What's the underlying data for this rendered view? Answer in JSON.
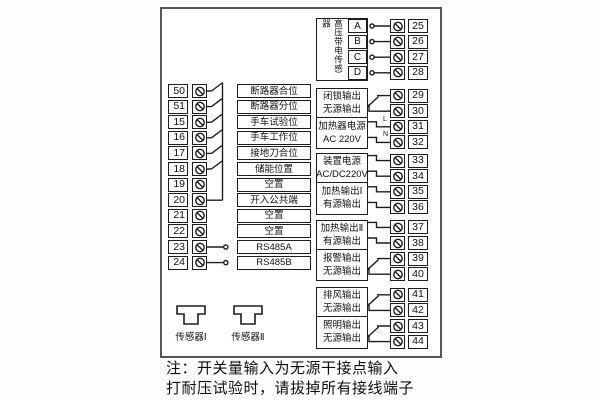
{
  "colors": {
    "line": "#1d1d1d",
    "frame": "#555555",
    "background": "#ffffff"
  },
  "left_strip": {
    "rows": [
      {
        "number": "50",
        "label": "断路器合位",
        "wire": "switch-to-common-bus"
      },
      {
        "number": "51",
        "label": "断路器分位",
        "wire": "switch-to-common-bus"
      },
      {
        "number": "15",
        "label": "手车试验位",
        "wire": "switch-to-common-bus"
      },
      {
        "number": "16",
        "label": "手车工作位",
        "wire": "switch-to-common-bus"
      },
      {
        "number": "17",
        "label": "接地刀合位",
        "wire": "switch-to-common-bus"
      },
      {
        "number": "18",
        "label": "储能位置",
        "wire": "switch-to-common-bus"
      },
      {
        "number": "19",
        "label": "空置",
        "wire": "none"
      },
      {
        "number": "20",
        "label": "开入公共端",
        "wire": "common-bus"
      },
      {
        "number": "21",
        "label": "空置",
        "wire": "none"
      },
      {
        "number": "22",
        "label": "空置",
        "wire": "none"
      },
      {
        "number": "23",
        "label": "RS485A",
        "wire": "stub-circle"
      },
      {
        "number": "24",
        "label": "RS485B",
        "wire": "stub-circle"
      }
    ]
  },
  "sensor_header": {
    "title": "高压带电传感器",
    "channels": [
      {
        "letter": "A",
        "number": "25"
      },
      {
        "letter": "B",
        "number": "26"
      },
      {
        "letter": "C",
        "number": "27"
      },
      {
        "letter": "D",
        "number": "28"
      }
    ]
  },
  "right_sections": [
    {
      "lines": [
        "闭锁输出",
        "无源输出"
      ],
      "terminals": [
        "29",
        "30"
      ],
      "wire": "relay-contact"
    },
    {
      "lines": [
        "加热器电源",
        "AC 220V"
      ],
      "terminals": [
        "31",
        "32"
      ],
      "wire": "line-neutral",
      "wire_labels": [
        "L",
        "N"
      ]
    },
    {
      "lines": [
        "装置电源",
        "AC/DC220V"
      ],
      "terminals": [
        "33",
        "34"
      ],
      "wire": "direct"
    },
    {
      "lines": [
        "加热输出Ⅰ",
        "有源输出"
      ],
      "terminals": [
        "35",
        "36"
      ],
      "wire": "direct"
    },
    {
      "lines": [
        "加热输出Ⅱ",
        "有源输出"
      ],
      "terminals": [
        "37",
        "38"
      ],
      "wire": "direct"
    },
    {
      "lines": [
        "报警输出",
        "无源输出"
      ],
      "terminals": [
        "39",
        "40"
      ],
      "wire": "relay-contact"
    },
    {
      "lines": [
        "排风输出",
        "无源输出"
      ],
      "terminals": [
        "41",
        "42"
      ],
      "wire": "relay-contact"
    },
    {
      "lines": [
        "照明输出",
        "无源输出"
      ],
      "terminals": [
        "43",
        "44"
      ],
      "wire": "relay-contact"
    }
  ],
  "sensors": [
    {
      "label": "传感器Ⅰ"
    },
    {
      "label": "传感器Ⅱ"
    }
  ],
  "notes": [
    "注：开关量输入为无源干接点输入",
    "打耐压试验时，请拔掉所有接线端子"
  ]
}
